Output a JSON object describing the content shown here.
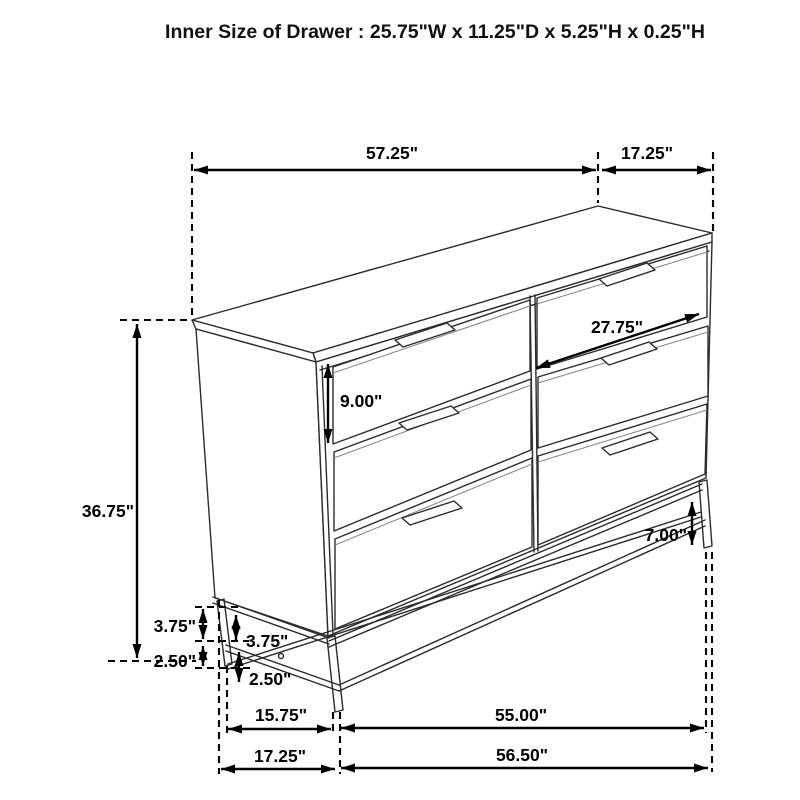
{
  "title": "Inner Size of Drawer : 25.75\"W x 11.25\"D x 5.25\"H x 0.25\"H",
  "dimensions": {
    "top_width": "57.25\"",
    "top_depth": "17.25\"",
    "drawer_inner_width": "27.75\"",
    "drawer_front_height": "9.00\"",
    "overall_height": "36.75\"",
    "leg_height_right": "7.00\"",
    "base_upper_outer": "3.75\"",
    "base_upper_inner": "3.75\"",
    "base_lower_outer": "2.50\"",
    "base_lower_inner": "2.50\"",
    "bottom_side_span": "15.75\"",
    "bottom_front_span": "55.00\"",
    "bottom_side_overall": "17.25\"",
    "bottom_front_overall": "56.50\""
  },
  "colors": {
    "background": "#ffffff",
    "furniture_line": "#2b2b2b",
    "dimension_line": "#000000"
  }
}
